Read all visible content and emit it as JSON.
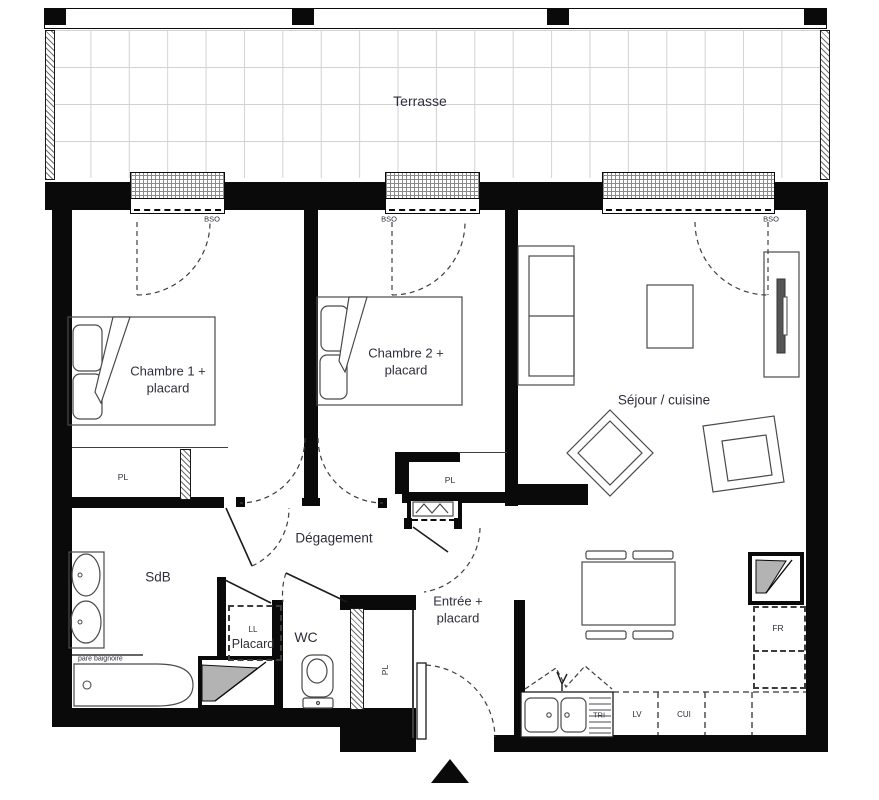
{
  "plan": {
    "rooms": {
      "terrace": {
        "label": "Terrasse"
      },
      "bedroom1": {
        "line1": "Chambre 1 +",
        "line2": "placard"
      },
      "bedroom2": {
        "line1": "Chambre 2 +",
        "line2": "placard"
      },
      "living_kitchen": {
        "label": "Séjour / cuisine"
      },
      "hallway": {
        "label": "Dégagement"
      },
      "bathroom": {
        "label": "SdB"
      },
      "toilet": {
        "label": "WC"
      },
      "laundry_closet": {
        "top": "LL",
        "label": "Placard"
      },
      "entry": {
        "line1": "Entrée +",
        "line2": "placard"
      }
    },
    "tags": {
      "bso": "BSO",
      "pl": "PL",
      "fr": "FR",
      "tri": "TRI",
      "lv": "LV",
      "cui": "CUI",
      "bath_screen": "pare baignoire"
    },
    "colors": {
      "wall": "#0a0a0a",
      "furniture_line": "#4a4a4a",
      "label_text": "#2e2e3d",
      "terrace_grid": "#d2d2d2",
      "shaft_fill": "#b3b3b3"
    }
  }
}
